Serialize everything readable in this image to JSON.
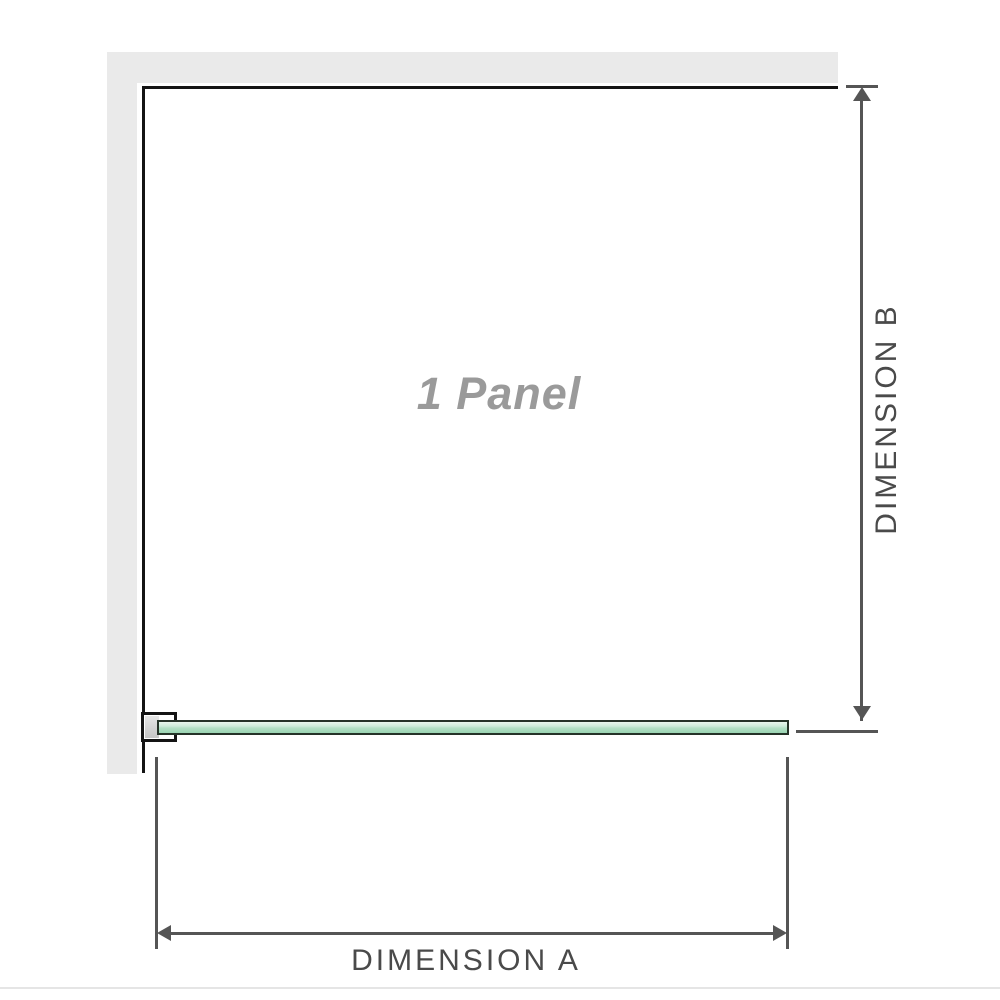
{
  "diagram": {
    "type": "shower-screen-dimension-diagram",
    "panel_label": "1 Panel",
    "dimension_a_label": "DIMENSION A",
    "dimension_b_label": "DIMENSION B"
  },
  "colors": {
    "wall": "#eaeaea",
    "outline": "#141414",
    "glass_border": "#253328",
    "glass_fill_light": "#e9f6ee",
    "glass_fill_dark": "#9bd4b2",
    "dim_line": "#555555",
    "dim_text": "#4a4a4a",
    "panel_text": "#9a9a9a"
  }
}
